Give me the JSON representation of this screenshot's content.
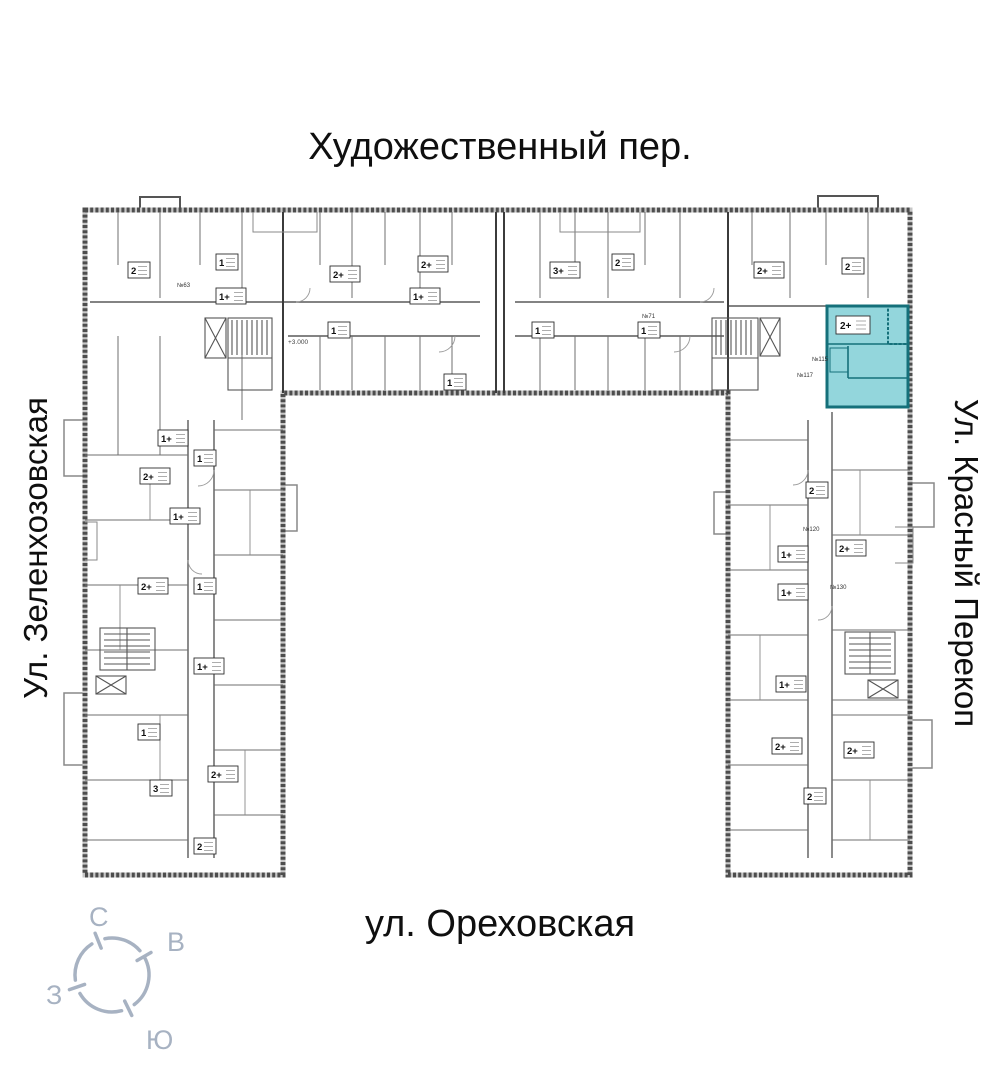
{
  "streets": {
    "top": "Художественный пер.",
    "left": "Ул. Зеленхозовская",
    "right": "Ул. Красный Перекоп",
    "bottom": "ул. Ореховская"
  },
  "compass": {
    "north": "С",
    "east": "В",
    "west": "З",
    "south": "Ю",
    "color": "#a7b2c2"
  },
  "plan": {
    "line_color": "#6f6f6f",
    "wall_color": "#3b3b3b",
    "highlight": {
      "type_label": "2+",
      "fill": "#93d6dc",
      "stroke": "#15707a"
    },
    "elevation_mark": "+3.000",
    "units": [
      {
        "x": 128,
        "y": 262,
        "t": "2"
      },
      {
        "x": 216,
        "y": 254,
        "t": "1"
      },
      {
        "x": 330,
        "y": 266,
        "t": "2+"
      },
      {
        "x": 418,
        "y": 256,
        "t": "2+"
      },
      {
        "x": 550,
        "y": 262,
        "t": "3+"
      },
      {
        "x": 612,
        "y": 254,
        "t": "2"
      },
      {
        "x": 754,
        "y": 262,
        "t": "2+"
      },
      {
        "x": 842,
        "y": 258,
        "t": "2"
      },
      {
        "x": 328,
        "y": 322,
        "t": "1"
      },
      {
        "x": 410,
        "y": 288,
        "t": "1+"
      },
      {
        "x": 532,
        "y": 322,
        "t": "1"
      },
      {
        "x": 638,
        "y": 322,
        "t": "1"
      },
      {
        "x": 444,
        "y": 374,
        "t": "1"
      },
      {
        "x": 216,
        "y": 288,
        "t": "1+"
      },
      {
        "x": 158,
        "y": 430,
        "t": "1+"
      },
      {
        "x": 140,
        "y": 468,
        "t": "2+"
      },
      {
        "x": 194,
        "y": 450,
        "t": "1"
      },
      {
        "x": 170,
        "y": 508,
        "t": "1+"
      },
      {
        "x": 138,
        "y": 578,
        "t": "2+"
      },
      {
        "x": 194,
        "y": 578,
        "t": "1"
      },
      {
        "x": 194,
        "y": 658,
        "t": "1+"
      },
      {
        "x": 138,
        "y": 724,
        "t": "1"
      },
      {
        "x": 150,
        "y": 780,
        "t": "3"
      },
      {
        "x": 208,
        "y": 766,
        "t": "2+"
      },
      {
        "x": 194,
        "y": 838,
        "t": "2"
      },
      {
        "x": 806,
        "y": 482,
        "t": "2"
      },
      {
        "x": 778,
        "y": 546,
        "t": "1+"
      },
      {
        "x": 836,
        "y": 540,
        "t": "2+"
      },
      {
        "x": 778,
        "y": 584,
        "t": "1+"
      },
      {
        "x": 776,
        "y": 676,
        "t": "1+"
      },
      {
        "x": 772,
        "y": 738,
        "t": "2+"
      },
      {
        "x": 844,
        "y": 742,
        "t": "2+"
      },
      {
        "x": 804,
        "y": 788,
        "t": "2"
      }
    ],
    "door_numbers": [
      {
        "x": 177,
        "y": 287,
        "label": "№63"
      },
      {
        "x": 642,
        "y": 318,
        "label": "№71"
      },
      {
        "x": 812,
        "y": 361,
        "label": "№115"
      },
      {
        "x": 797,
        "y": 377,
        "label": "№117"
      },
      {
        "x": 803,
        "y": 531,
        "label": "№120"
      },
      {
        "x": 830,
        "y": 589,
        "label": "№130"
      }
    ]
  }
}
